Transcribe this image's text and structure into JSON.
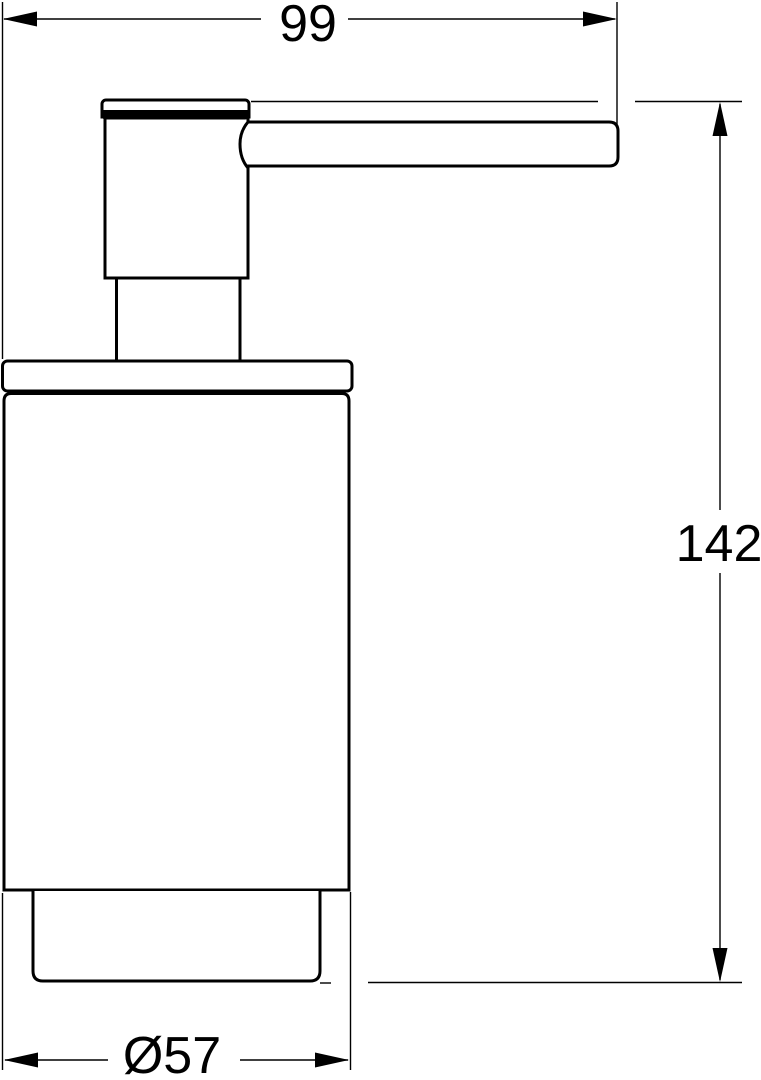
{
  "drawing": {
    "background_color": "#ffffff",
    "line_color": "#000000",
    "view": "soap-dispenser-side-elevation",
    "dimensions": {
      "width": {
        "label": "99",
        "value": 99
      },
      "height": {
        "label": "142",
        "value": 142
      },
      "diameter": {
        "label": "Ø57",
        "value": 57
      }
    }
  }
}
